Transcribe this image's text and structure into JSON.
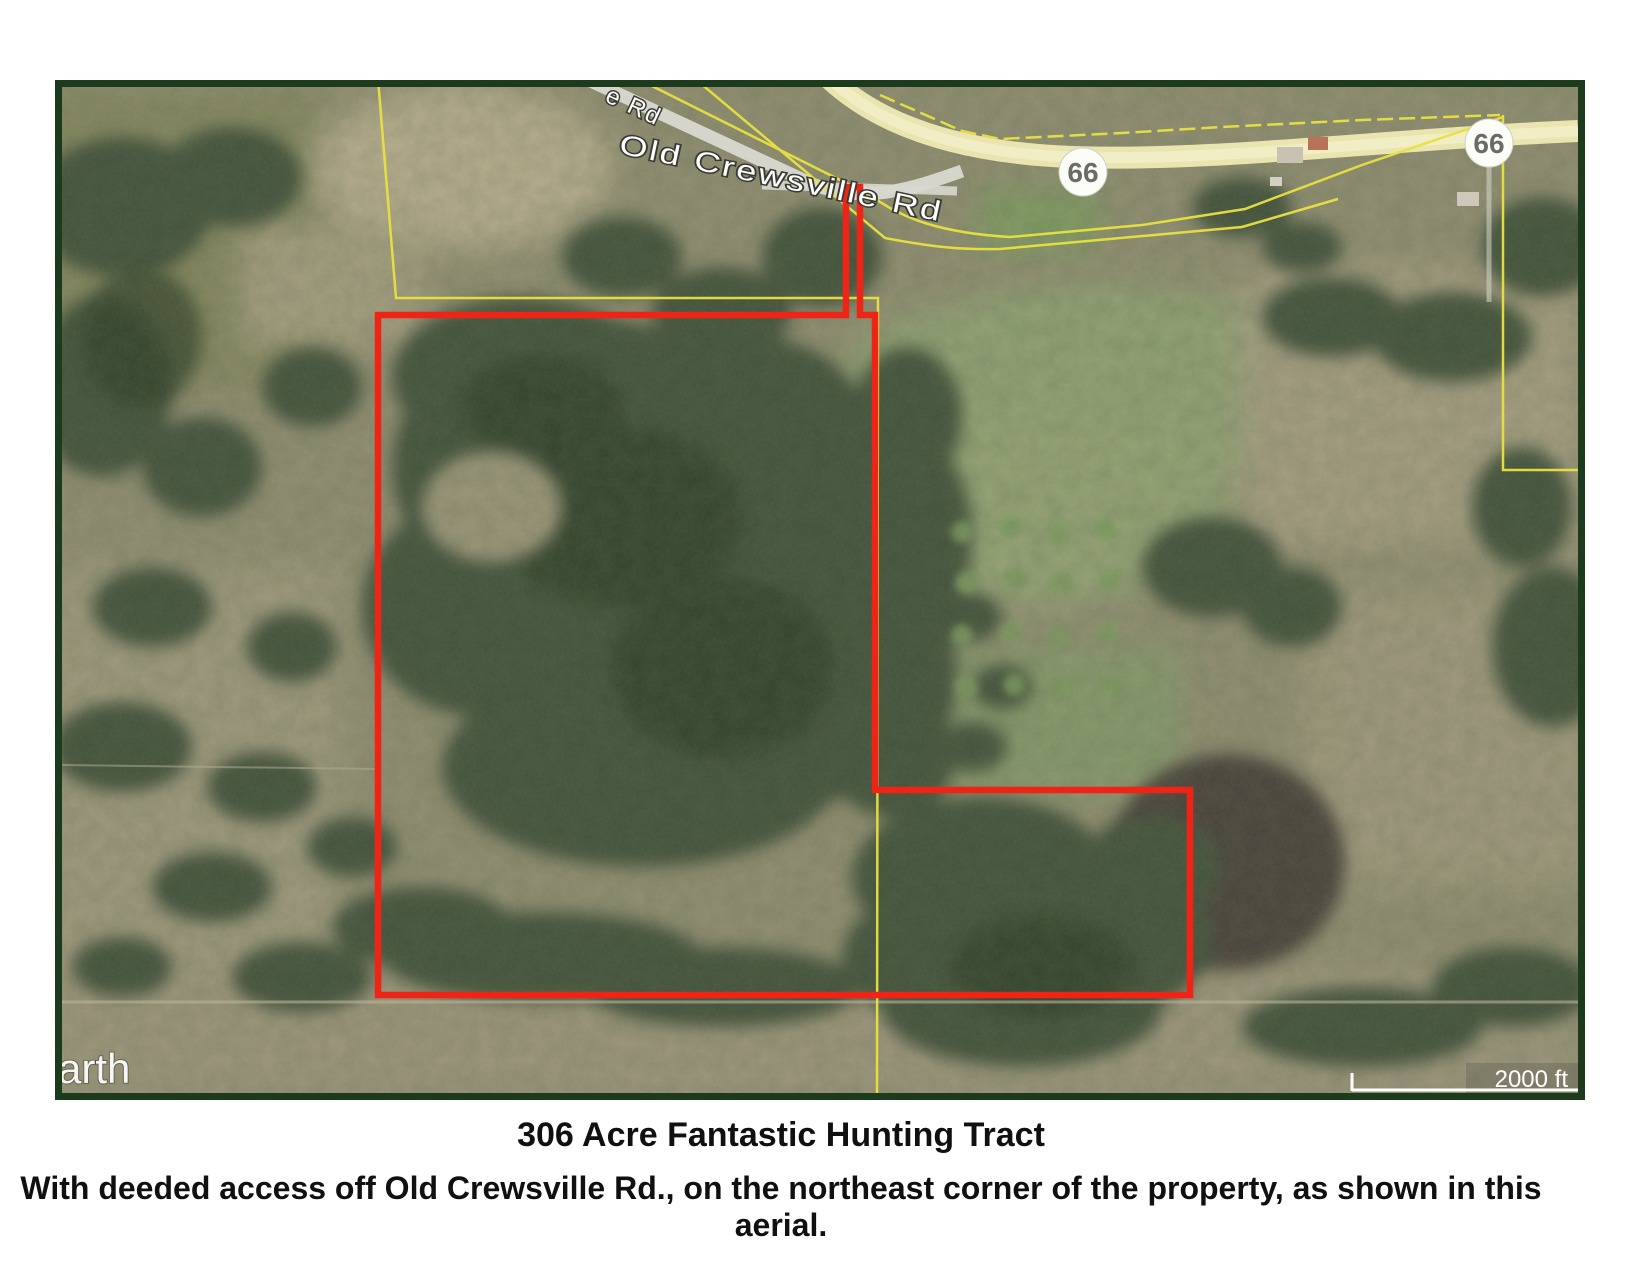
{
  "caption": {
    "title": "306 Acre Fantastic Hunting Tract",
    "subtitle": "With deeded access off Old Crewsville Rd., on the northeast corner of the property, as shown in this aerial."
  },
  "map": {
    "watermark": "arth",
    "scale_label": "2000 ft",
    "road_label_main": "Old Crewsville Rd",
    "road_label_partial": "e Rd",
    "route_shield_1": "66",
    "route_shield_2": "66",
    "colors": {
      "frame-green": "#1c3a1c",
      "boundary-red": "#ee2417",
      "parcel-yellow": "#e8e23f",
      "terrain-base": "#8f8c70",
      "forest-green": "#42513a",
      "forest-dark": "#2e3d28",
      "road-pale": "#e9e4b0",
      "road-gray": "#d5d5cc",
      "burned-field": "#4a423b",
      "label-white": "#ffffff"
    }
  }
}
